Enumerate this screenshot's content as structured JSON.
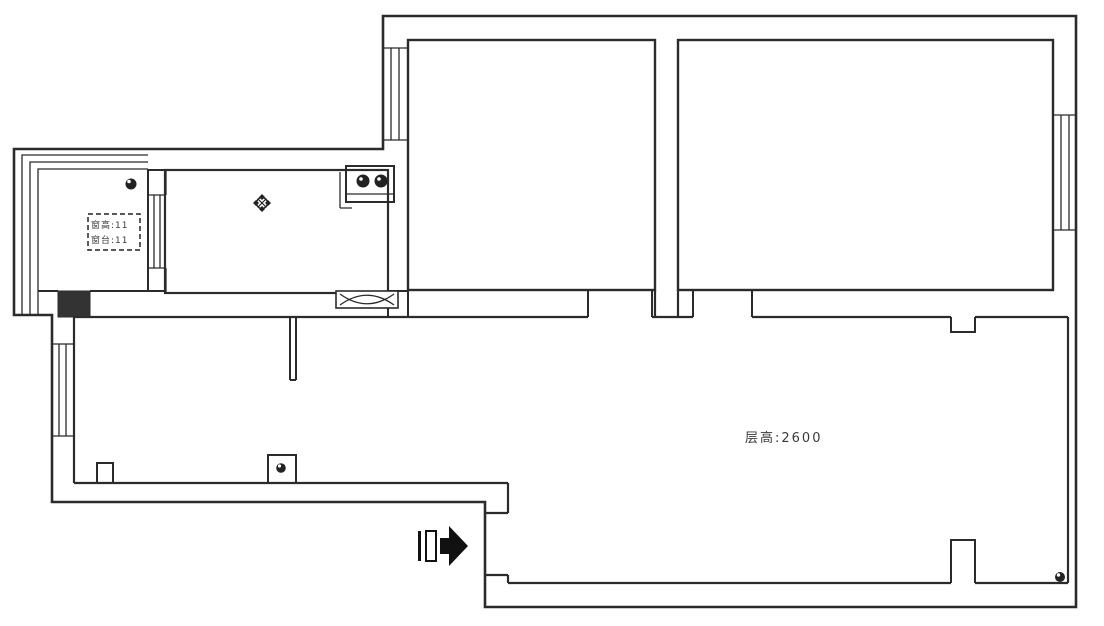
{
  "drawing": {
    "type": "apartment-floor-plan",
    "annotations": {
      "ceiling_height_label": "层高:2600",
      "balcony_note_line1": "窗高:11",
      "balcony_note_line2": "窗台:11"
    },
    "rooms": [
      {
        "name": "bedroom-a",
        "position": "top-left"
      },
      {
        "name": "bedroom-b",
        "position": "top-right"
      },
      {
        "name": "kitchen",
        "position": "mid-left"
      },
      {
        "name": "balcony",
        "position": "far-left"
      },
      {
        "name": "bathroom",
        "position": "lower-left"
      },
      {
        "name": "living-room",
        "position": "center-right"
      }
    ],
    "symbols": [
      "entry-arrow-icon",
      "stove-symbol",
      "ceiling-lamp-icon",
      "ceiling-light-icon",
      "pass-through-window",
      "structural-column"
    ],
    "colors": {
      "wall_line": "#2b2b2b",
      "column_fill": "#333333",
      "arrow_fill": "#111111",
      "background": "#ffffff"
    }
  }
}
